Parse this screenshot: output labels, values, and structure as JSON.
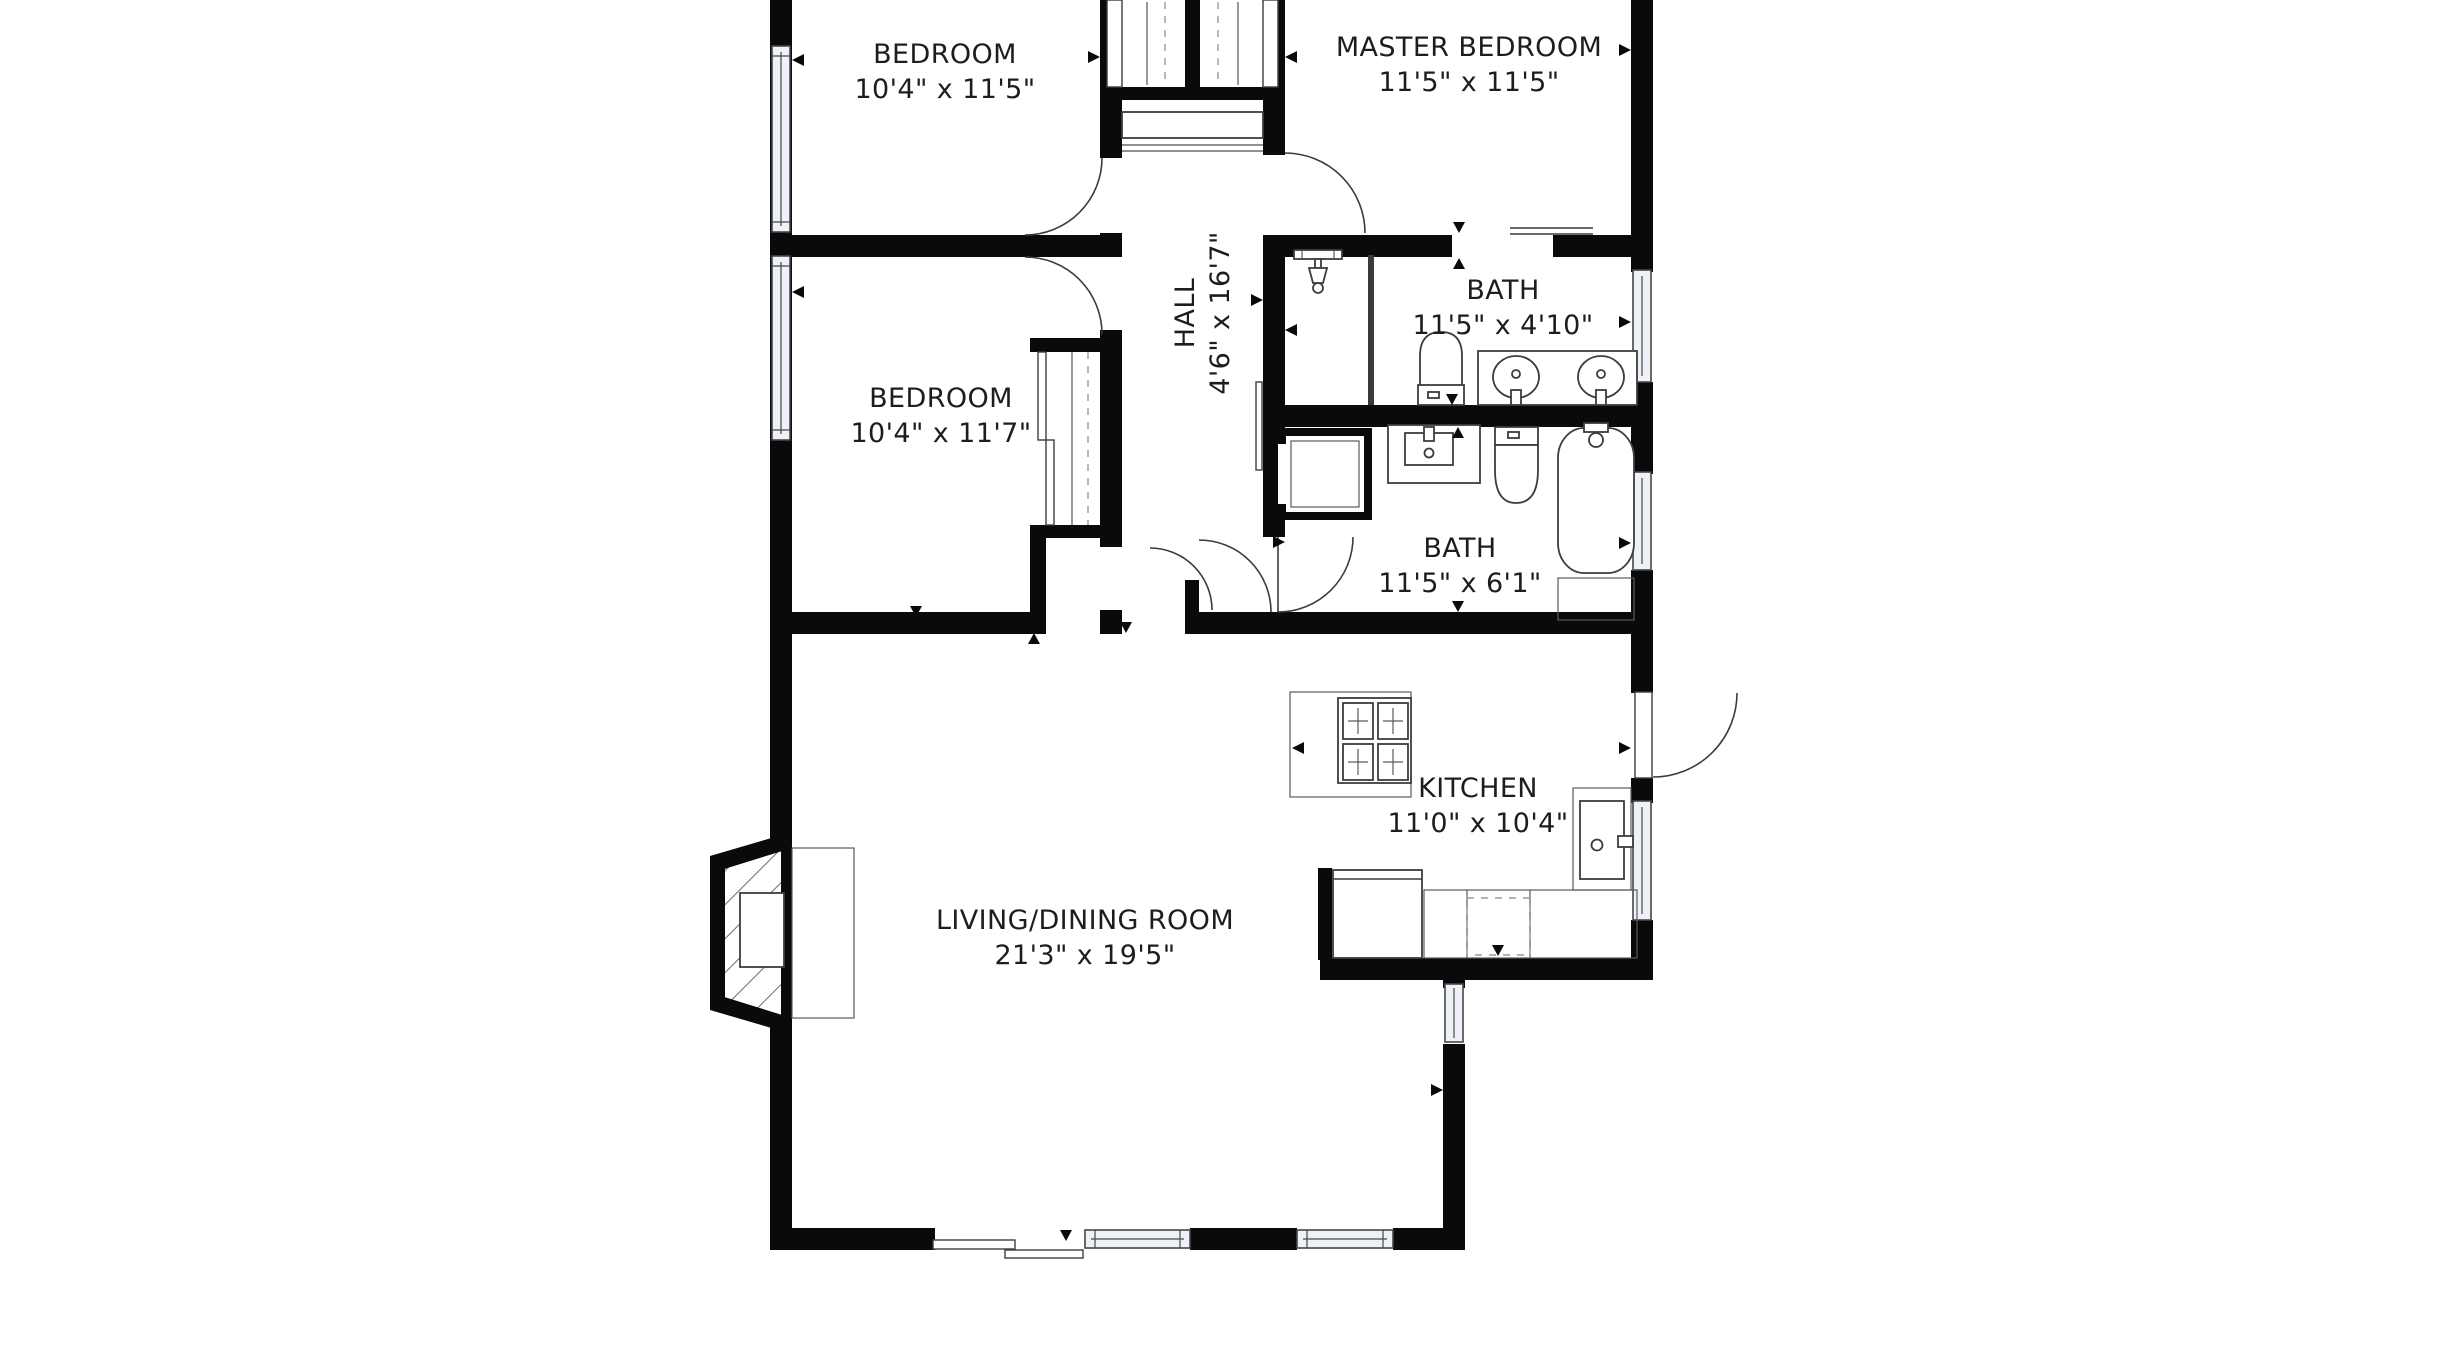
{
  "plan": {
    "title": "apartment floor plan",
    "rooms": [
      {
        "id": "bedroom-top",
        "name": "BEDROOM",
        "dims": "10'4\" x 11'5\""
      },
      {
        "id": "master-bedroom",
        "name": "MASTER BEDROOM",
        "dims": "11'5\" x 11'5\""
      },
      {
        "id": "hall",
        "name": "HALL",
        "dims": "4'6\" x 16'7\""
      },
      {
        "id": "bath-master",
        "name": "BATH",
        "dims": "11'5\" x 4'10\""
      },
      {
        "id": "bedroom-mid",
        "name": "BEDROOM",
        "dims": "10'4\" x 11'7\""
      },
      {
        "id": "bath-hall",
        "name": "BATH",
        "dims": "11'5\" x 6'1\""
      },
      {
        "id": "kitchen",
        "name": "KITCHEN",
        "dims": "11'0\" x 10'4\""
      },
      {
        "id": "living-dining",
        "name": "LIVING/DINING ROOM",
        "dims": "21'3\" x 19'5\""
      }
    ],
    "fixtures": [
      "toilet-icon",
      "double-vanity-sink-icon",
      "shower-head-icon",
      "shower-stall-icon",
      "bathtub-icon",
      "vanity-sink-icon",
      "stove-icon",
      "kitchen-sink-icon",
      "refrigerator-icon",
      "dishwasher-icon",
      "fireplace-icon",
      "sliding-patio-door-icon",
      "closet-sliding-doors-icon",
      "towel-bar-icon",
      "window-icon",
      "door-swing-icon"
    ],
    "colors": {
      "wall": "#0a0a0a",
      "background": "#ffffff",
      "window_fill": "#eef1f6",
      "line": "#3c3c3c",
      "text": "#1d1d1d"
    }
  }
}
